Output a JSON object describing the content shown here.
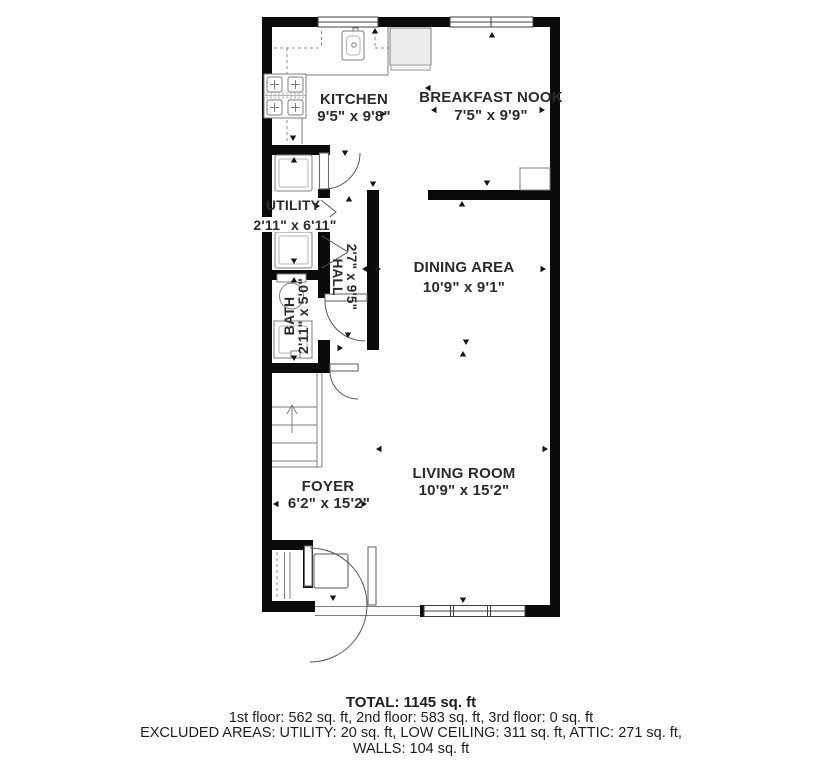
{
  "rooms": {
    "kitchen": {
      "name": "KITCHEN",
      "dims": "9'5\" x 9'8\""
    },
    "breakfast_nook": {
      "name": "BREAKFAST NOOK",
      "dims": "7'5\" x 9'9\""
    },
    "utility": {
      "name": "UTILITY",
      "dims": "2'11\" x 6'11\""
    },
    "hall": {
      "name": "HALL",
      "dims": "2'7\" x 9'5\""
    },
    "bath": {
      "name": "BATH",
      "dims": "2'11\" x 5'0\""
    },
    "dining_area": {
      "name": "DINING AREA",
      "dims": "10'9\" x 9'1\""
    },
    "living_room": {
      "name": "LIVING ROOM",
      "dims": "10'9\" x 15'2\""
    },
    "foyer": {
      "name": "FOYER",
      "dims": "6'2\" x 15'2\""
    }
  },
  "summary": {
    "total": "TOTAL: 1145 sq. ft",
    "floors": "1st floor: 562 sq. ft, 2nd floor: 583 sq. ft, 3rd floor: 0 sq. ft",
    "excluded_areas": "EXCLUDED AREAS: UTILITY: 20 sq. ft, LOW CEILING: 311 sq. ft, ATTIC: 271 sq. ft,",
    "walls": "WALLS: 104 sq. ft"
  },
  "colors": {
    "wall": "#0a0a0a",
    "fixture_line": "#7d7d7d",
    "door_arc": "#555555",
    "label_text": "#2b2b2b"
  }
}
